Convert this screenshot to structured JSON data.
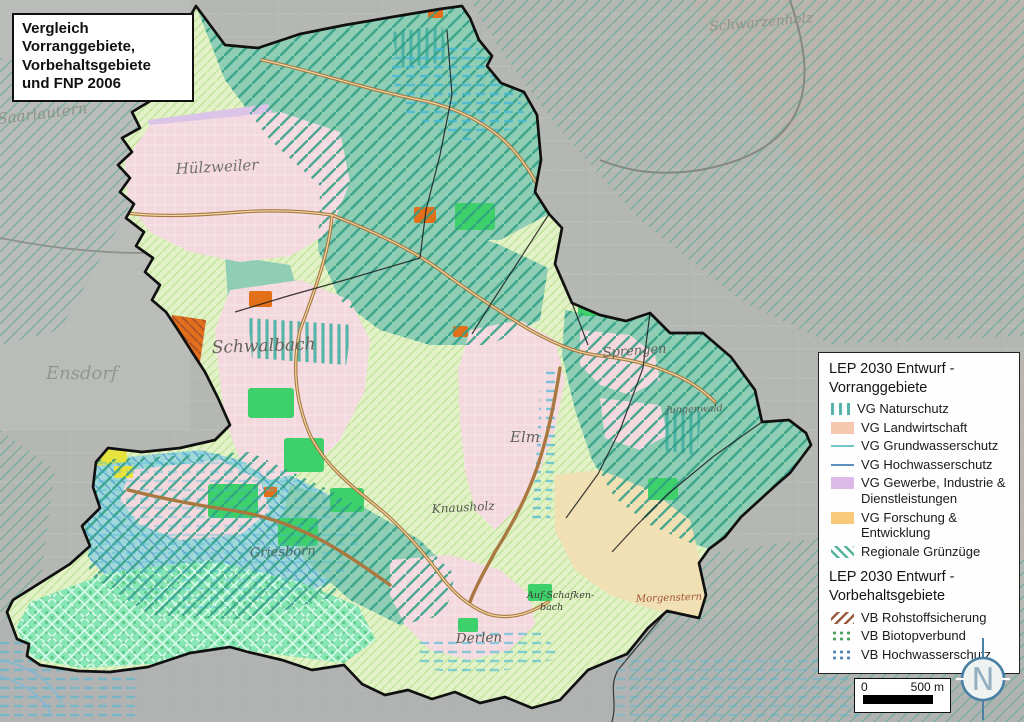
{
  "title_box": {
    "lines": [
      "Vergleich",
      "Vorranggebiete,",
      "Vorbehaltsgebiete",
      "und FNP 2006"
    ]
  },
  "legend": {
    "sections": [
      {
        "title_lines": [
          "LEP 2030 Entwurf -",
          "Vorranggebiete"
        ],
        "items": [
          {
            "id": "vg-naturschutz",
            "label": "VG Naturschutz",
            "swatch": "vertical-bars",
            "color": "#58b4aa"
          },
          {
            "id": "vg-landwirtschaft",
            "label": "VG Landwirtschaft",
            "swatch": "fill",
            "color": "#f6c8b0"
          },
          {
            "id": "vg-grundwasserschutz",
            "label": "VG Grundwasserschutz",
            "swatch": "line",
            "color": "#74c4c8"
          },
          {
            "id": "vg-hochwasserschutz",
            "label": "VG Hochwasserschutz",
            "swatch": "line",
            "color": "#5d90ba"
          },
          {
            "id": "vg-gewerbe",
            "label": "VG Gewerbe,  Industrie & Dienstleistungen",
            "swatch": "fill",
            "color": "#dcb9e6"
          },
          {
            "id": "vg-forschung",
            "label": "VG Forschung & Entwicklung",
            "swatch": "fill",
            "color": "#f8c97a"
          },
          {
            "id": "regionale-gruenzuege",
            "label": "Regionale Grünzüge",
            "swatch": "diag-lines",
            "color": "#55b49c"
          }
        ]
      },
      {
        "title_lines": [
          "LEP 2030 Entwurf -",
          "Vorbehaltsgebiete"
        ],
        "items": [
          {
            "id": "vb-rohstoffsicherung",
            "label": "VB Rohstoffsicherung",
            "swatch": "diag-lines-back",
            "color": "#9d5b40"
          },
          {
            "id": "vb-biotopverbund",
            "label": "VB Biotopverbund",
            "swatch": "dots",
            "color": "#4aa35f"
          },
          {
            "id": "vb-hochwasserschutz",
            "label": "VB Hochwasserschutz",
            "swatch": "dots",
            "color": "#4e84b6"
          }
        ]
      }
    ]
  },
  "scale_bar": {
    "start": "0",
    "end": "500 m"
  },
  "north_indicator": {
    "letter": "N"
  },
  "map": {
    "labels": [
      {
        "text": "Saarlautern",
        "x": -2,
        "y": 124,
        "size": 15,
        "color": "#8f918b",
        "rotate": -7,
        "anchor": "start"
      },
      {
        "text": "Schwarzenholz",
        "x": 710,
        "y": 31,
        "size": 13.5,
        "color": "#8f918b",
        "rotate": -5,
        "anchor": "start"
      },
      {
        "text": "Ensdorf",
        "x": 46,
        "y": 379,
        "size": 18,
        "color": "#93958f",
        "rotate": 0,
        "anchor": "start"
      },
      {
        "text": "Hülzweiler",
        "x": 176,
        "y": 174,
        "size": 15,
        "color": "#70726a",
        "rotate": -3,
        "anchor": "start"
      },
      {
        "text": "Schwalbach",
        "x": 212,
        "y": 353,
        "size": 17,
        "color": "#62645c",
        "rotate": -2,
        "anchor": "start"
      },
      {
        "text": "Sprengen",
        "x": 603,
        "y": 357,
        "size": 13,
        "color": "#62645c",
        "rotate": -4,
        "anchor": "start"
      },
      {
        "text": "Elm",
        "x": 510,
        "y": 442,
        "size": 15,
        "color": "#62645c",
        "rotate": 0,
        "anchor": "start"
      },
      {
        "text": "Knausholz",
        "x": 432,
        "y": 513,
        "size": 12,
        "color": "#565850",
        "rotate": -3,
        "anchor": "start"
      },
      {
        "text": "Griesborn",
        "x": 250,
        "y": 557,
        "size": 13,
        "color": "#4f6a60",
        "rotate": -2,
        "anchor": "start"
      },
      {
        "text": "Derlen",
        "x": 456,
        "y": 643,
        "size": 13.5,
        "color": "#565850",
        "rotate": -2,
        "anchor": "start"
      },
      {
        "text": "Auf-Schafken-",
        "x": 527,
        "y": 598,
        "size": 9.5,
        "color": "#3a3c36",
        "rotate": 0,
        "anchor": "start"
      },
      {
        "text": "bach",
        "x": 540,
        "y": 610,
        "size": 9.5,
        "color": "#3a3c36",
        "rotate": 0,
        "anchor": "start"
      },
      {
        "text": "Morgenstern",
        "x": 636,
        "y": 602,
        "size": 10,
        "color": "#a05638",
        "rotate": -2,
        "anchor": "start"
      },
      {
        "text": "Jungenwald",
        "x": 666,
        "y": 413,
        "size": 9.5,
        "color": "#5c5e56",
        "rotate": -2,
        "anchor": "start"
      }
    ]
  }
}
